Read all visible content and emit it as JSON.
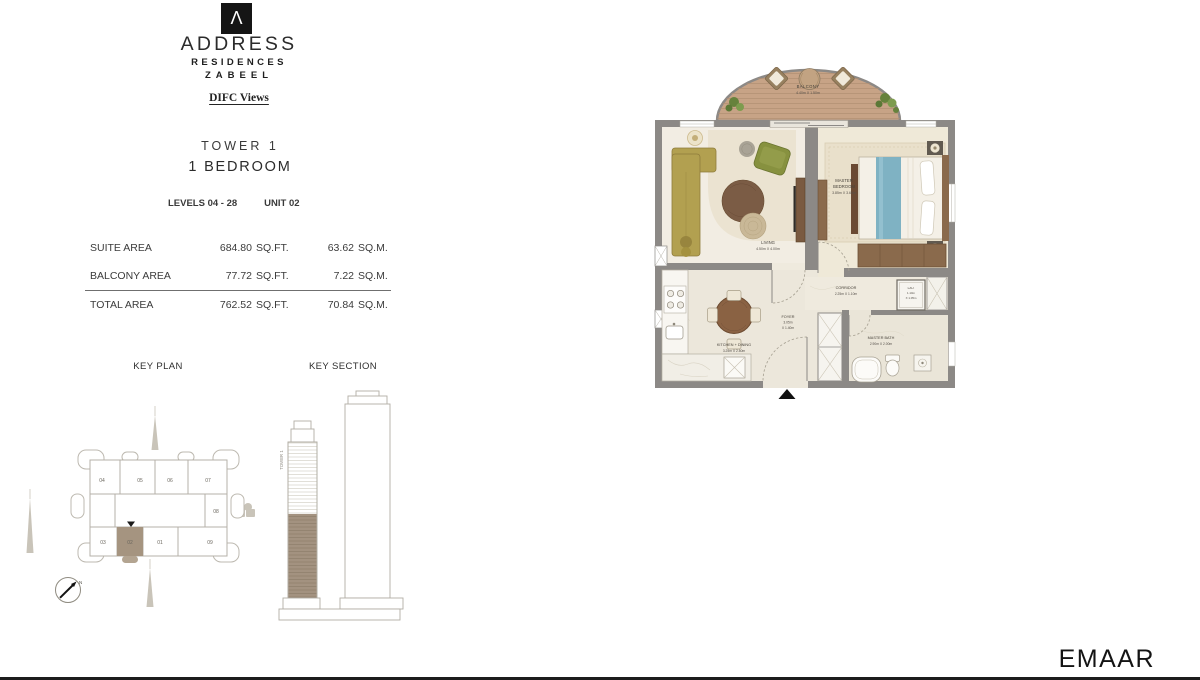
{
  "brand": {
    "logo_letter": "Λ",
    "name": "ADDRESS",
    "line1": "RESIDENCES",
    "line2": "ZABEEL",
    "tagline": "DIFC Views"
  },
  "unit": {
    "tower": "TOWER 1",
    "type": "1 BEDROOM",
    "levels": "LEVELS 04 - 28",
    "number": "UNIT 02"
  },
  "areas": {
    "rows": [
      {
        "label": "SUITE AREA",
        "sqft": "684.80",
        "sqft_unit": "SQ.FT.",
        "sqm": "63.62",
        "sqm_unit": "SQ.M."
      },
      {
        "label": "BALCONY AREA",
        "sqft": "77.72",
        "sqft_unit": "SQ.FT.",
        "sqm": "7.22",
        "sqm_unit": "SQ.M."
      },
      {
        "label": "TOTAL AREA",
        "sqft": "762.52",
        "sqft_unit": "SQ.FT.",
        "sqm": "70.84",
        "sqm_unit": "SQ.M."
      }
    ]
  },
  "key_plan": {
    "title": "KEY PLAN",
    "north_label": "N",
    "highlighted": "02",
    "units": {
      "u01": "01",
      "u02": "02",
      "u03": "03",
      "u04": "04",
      "u05": "05",
      "u06": "06",
      "u07": "07",
      "u08": "08",
      "u09": "09"
    }
  },
  "key_section": {
    "title": "KEY SECTION",
    "tower_label": "TOWER 1"
  },
  "plan": {
    "rooms": {
      "balcony": {
        "name": "BALCONY",
        "dims": "4.40m X 1.50m"
      },
      "living": {
        "name": "LIVING",
        "dims": "4.50m X 4.00m"
      },
      "master_bedroom": {
        "name_l1": "MASTER",
        "name_l2": "BEDROOM",
        "dims": "3.85m X 3.60m"
      },
      "corridor": {
        "name": "CORRIDOR",
        "dims": "2.25m X 1.10m"
      },
      "laundry": {
        "name": "LAU.",
        "dims_l1": "1.10m",
        "dims_l2": "X 1.05m"
      },
      "foyer": {
        "name": "FOYER",
        "dims_l1": "3.05m",
        "dims_l2": "X 1.40m"
      },
      "kitchen": {
        "name": "KITCHEN + DINING",
        "dims": "3.25m X 2.80m"
      },
      "master_bath": {
        "name": "MASTER BATH",
        "dims": "2.90m X 2.00m"
      }
    }
  },
  "footer": {
    "logo": "EMAAR"
  },
  "colors": {
    "wall": "#8c8986",
    "balcony_wood": "#c7a386",
    "unit_highlight": "#a59480",
    "bed_accent": "#7fb2c3",
    "sofa_olive": "#b2a050",
    "chair_green": "#87913f"
  }
}
